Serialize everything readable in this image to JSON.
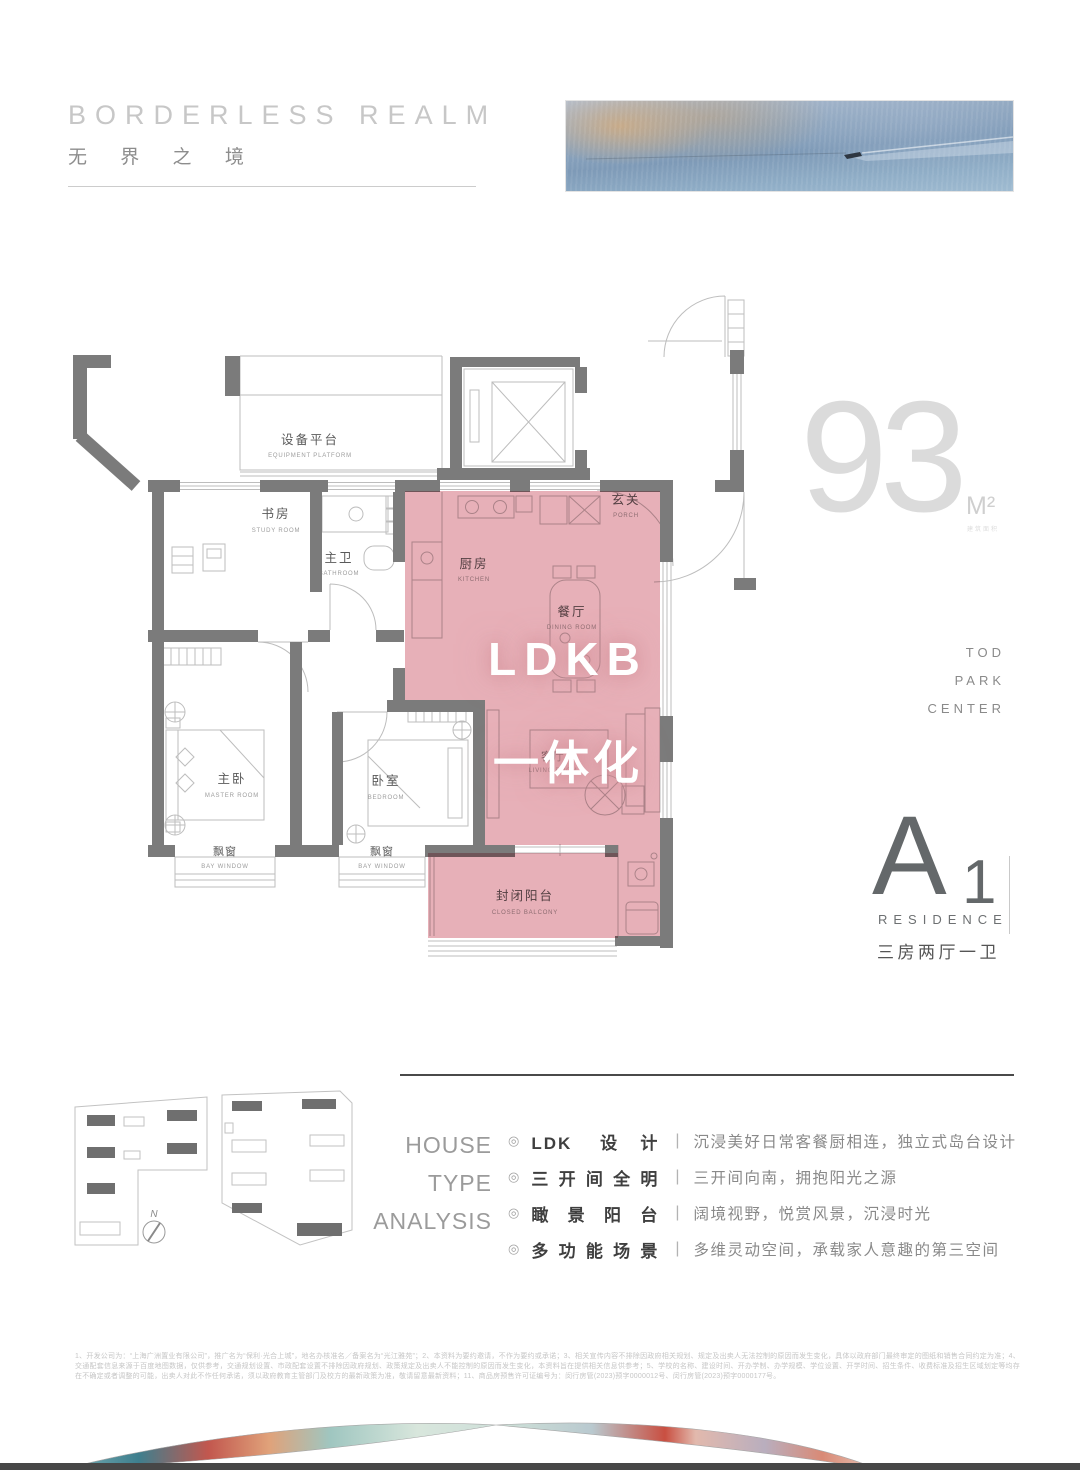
{
  "header": {
    "title_en": "BORDERLESS REALM",
    "title_zh": "无 界 之 境"
  },
  "area": {
    "value": "93",
    "unit": "M²",
    "unit_caption": "建筑面积",
    "tagline": [
      "TOD",
      "PARK",
      "CENTER"
    ]
  },
  "residence": {
    "letter": "A",
    "number": "1",
    "subtitle": "RESIDENCE",
    "spec": "三房两厅一卫"
  },
  "floorplan": {
    "highlight": {
      "line1": "LDKB",
      "line2": "一体化"
    },
    "rooms": {
      "equipment": {
        "zh": "设备平台",
        "en": "EQUIPMENT PLATFORM"
      },
      "study": {
        "zh": "书房",
        "en": "STUDY ROOM"
      },
      "bath": {
        "zh": "主卫",
        "en": "BATHROOM"
      },
      "porch": {
        "zh": "玄关",
        "en": "PORCH"
      },
      "kitchen": {
        "zh": "厨房",
        "en": "KITCHEN"
      },
      "dining": {
        "zh": "餐厅",
        "en": "DINING ROOM"
      },
      "living": {
        "zh": "客厅",
        "en": "LIVING ROOM"
      },
      "master": {
        "zh": "主卧",
        "en": "MASTER ROOM"
      },
      "bedroom": {
        "zh": "卧室",
        "en": "BEDROOM"
      },
      "bay1": {
        "zh": "飘窗",
        "en": "BAY WINDOW"
      },
      "bay2": {
        "zh": "飘窗",
        "en": "BAY WINDOW"
      },
      "balcony": {
        "zh": "封闭阳台",
        "en": "CLOSED BALCONY"
      }
    }
  },
  "siteplan": {
    "compass": "N"
  },
  "analysis": {
    "heading": [
      "HOUSE",
      "TYPE",
      "ANALYSIS"
    ],
    "bullet_icon": "◎",
    "separator": "|",
    "items": [
      {
        "title": "LDK 设计",
        "desc": "沉浸美好日常客餐厨相连，独立式岛台设计"
      },
      {
        "title": "三开间全明",
        "desc": "三开间向南，拥抱阳光之源"
      },
      {
        "title": "瞰景阳台",
        "desc": "阔境视野，悦赏风景，沉浸时光"
      },
      {
        "title": "多功能场景",
        "desc": "多维灵动空间，承载家人意趣的第三空间"
      }
    ]
  },
  "disclaimer": "1、开发公司为：“上海广洲置业有限公司”，推广名为“保利·光合上城”，地名办核准名／备案名为“光江雅苑”；2、本资料为要约邀请，不作为要约或承诺；3、相关宣传内容不排除因政府相关规划、规定及出卖人无法控制的原因而发生变化，具体以政府部门最终审定的图纸和销售合同约定为准；4、交通配套信息来源于百度地图数据，仅供参考，交通规划设置、市政配套设置不排除因政府规划、政策规定及出卖人不能控制的原因而发生变化，本资料旨在提供相关信息供参考；5、学校的名称、建设时间、开办学制、办学规模、学位设置、开学时间、招生条件、收费标准及招生区域划定等均存在不确定或者调整的可能，出卖人对此不作任何承诺，须以政府教育主管部门及校方的最新政策为准，敬请留意最新资料；11、商品房预售许可证编号为：闵行房管(2023)预字0000012号、闵行房管(2023)预字0000177号。",
  "colors": {
    "wall": "#7b7b7b",
    "thin_line": "#bdbdbd",
    "pink": "#d8808c",
    "accent_text": "#ffffff",
    "water": "#8da5be"
  }
}
